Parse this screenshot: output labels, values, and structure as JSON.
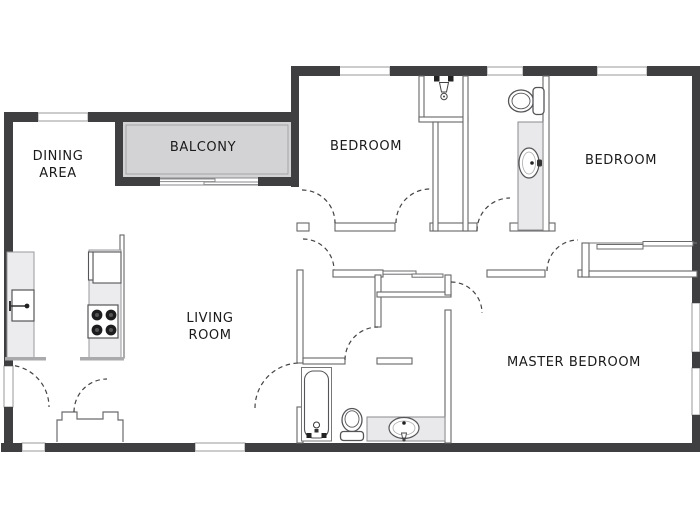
{
  "title": "Apartment Floor Plan",
  "rooms": {
    "dining_area": {
      "label_line1": "DINING",
      "label_line2": "AREA"
    },
    "balcony": {
      "label": "BALCONY"
    },
    "bedroom_top": {
      "label": "BEDROOM"
    },
    "bedroom_right": {
      "label": "BEDROOM"
    },
    "living_room": {
      "label_line1": "LIVING",
      "label_line2": "ROOM"
    },
    "master_bedroom": {
      "label": "MASTER BEDROOM"
    }
  },
  "fixtures": [
    "shower",
    "linen-closet",
    "toilet-upper",
    "vanity-sink-upper",
    "refrigerator",
    "stove-4-burner",
    "kitchen-sink",
    "entry-closet",
    "bathtub",
    "toilet-lower",
    "vanity-sink-lower",
    "hall-sliding-closet",
    "master-sliding-closet",
    "balcony-sliding-door"
  ],
  "colors": {
    "exterior_wall": "#3f3f41",
    "interior_line": "#666666",
    "balcony_fill": "#d3d3d5",
    "counter_fill": "#ececee",
    "vanity_fill": "#e9e9eb",
    "fixture_stroke": "#555558",
    "window_stroke": "#999999",
    "cap_gray": "#aaaaad",
    "dash": "#444444",
    "burner": "#1d1d1f",
    "white": "#ffffff",
    "text": "#1a1a1a",
    "background": "#ffffff"
  }
}
